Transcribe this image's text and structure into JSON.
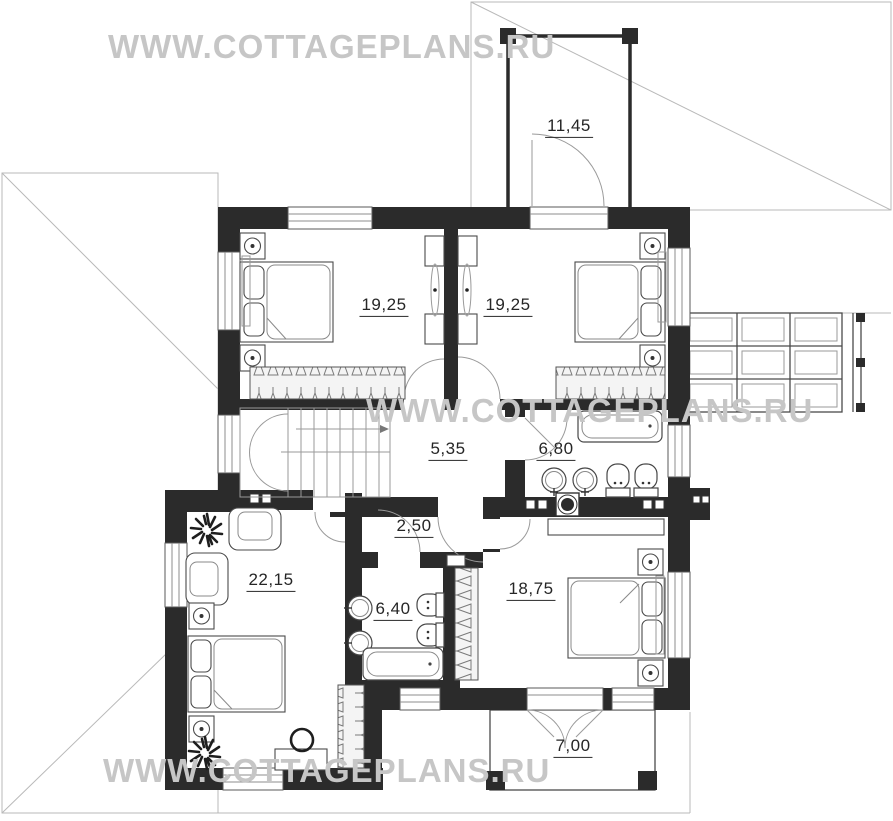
{
  "watermark": {
    "text": "WWW.COTTAGEPLANS.RU"
  },
  "rooms": [
    {
      "id": "balcony",
      "area": "11,45"
    },
    {
      "id": "bedroom-1",
      "area": "19,25"
    },
    {
      "id": "bedroom-2",
      "area": "19,25"
    },
    {
      "id": "stair-hall",
      "area": "5,35"
    },
    {
      "id": "bathroom-1",
      "area": "6,80"
    },
    {
      "id": "corridor",
      "area": "2,50"
    },
    {
      "id": "master-bedroom",
      "area": "22,15"
    },
    {
      "id": "bathroom-2",
      "area": "6,40"
    },
    {
      "id": "bedroom-3",
      "area": "18,75"
    },
    {
      "id": "terrace",
      "area": "7,00"
    }
  ],
  "colors": {
    "wall": "#2b2b2b",
    "furniture_line": "#4a4a4a",
    "roof_line": "#b9b9b9",
    "watermark": "#c6c6c6",
    "label": "#262626"
  },
  "symbols": [
    "double-bed",
    "nightstand-lamp",
    "wardrobe-hangers",
    "staircase-up",
    "bathtub",
    "washbasin",
    "toilet",
    "armchair",
    "desk-chair",
    "potted-plant",
    "ventilation-fan",
    "door-swing",
    "window",
    "balcony-railing",
    "pergola-grid",
    "terrace-posts"
  ]
}
